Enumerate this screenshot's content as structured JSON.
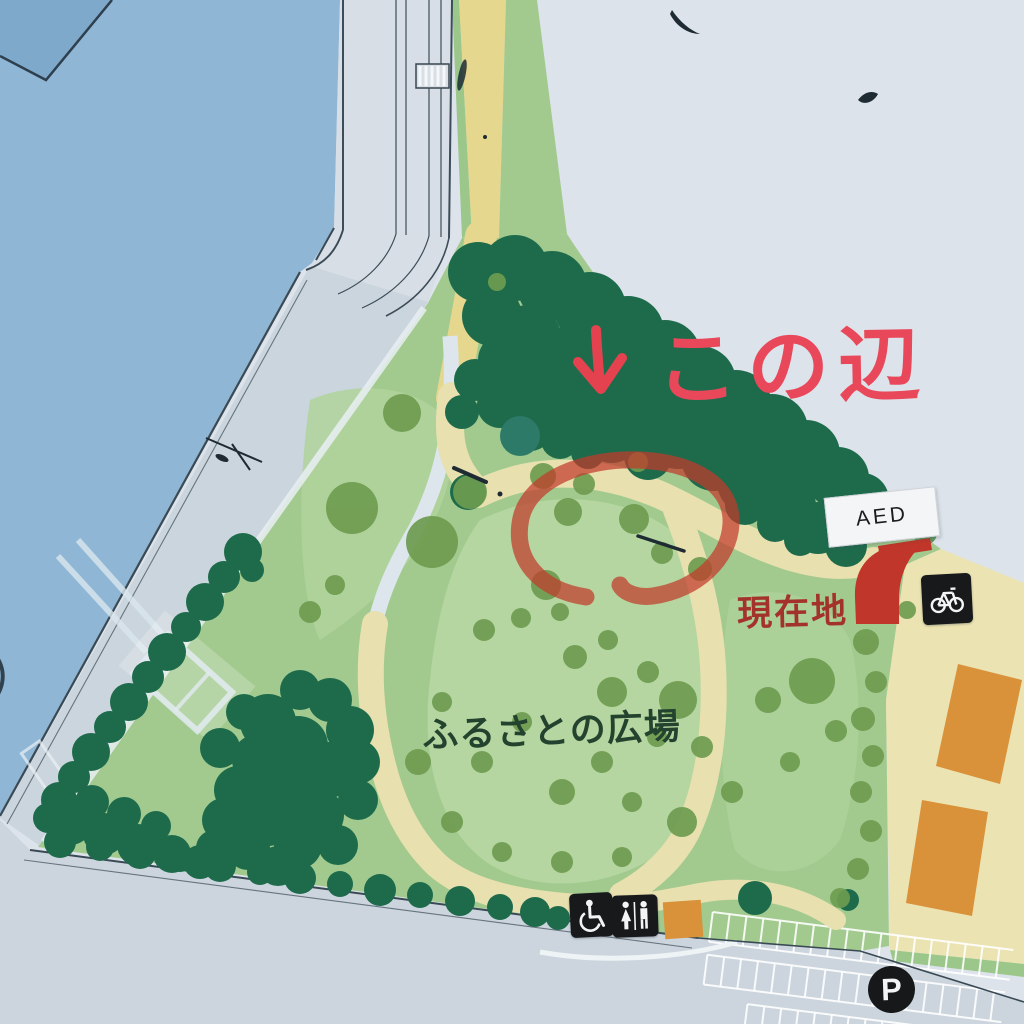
{
  "annotation": {
    "arrow_glyph": "↓",
    "text": "この辺",
    "color": "#e8485a",
    "circle_color": "#c23a2b"
  },
  "labels": {
    "plaza_name": "ふるさとの広場",
    "current_location": "現在地",
    "aed": "AED",
    "parking_initial": "P",
    "left_edge_fragment": "）"
  },
  "icons": [
    {
      "name": "bicycle-parking-icon"
    },
    {
      "name": "wheelchair-accessible-icon"
    },
    {
      "name": "restroom-icon"
    },
    {
      "name": "parking-icon"
    },
    {
      "name": "current-location-marker"
    },
    {
      "name": "aed-signboard"
    },
    {
      "name": "hand-drawn-circle-annotation"
    },
    {
      "name": "hand-drawn-arrow-annotation"
    }
  ],
  "colors": {
    "water": "#8fb6d5",
    "water_dark": "#7fa9cb",
    "park_green": "#a2ca8f",
    "lawn_green": "#b5d6a0",
    "tree_dark": "#1e6b4c",
    "tree_olive": "#6e9c50",
    "path_beige": "#e8e0af",
    "road_yellow": "#e5d78d",
    "promenade_gray": "#cbd5dd",
    "outside_pale": "#dde3ea",
    "building_orange": "#d9913a",
    "icon_black": "#17191b",
    "annotation_red": "#e8485a",
    "marker_red": "#c1362a"
  }
}
